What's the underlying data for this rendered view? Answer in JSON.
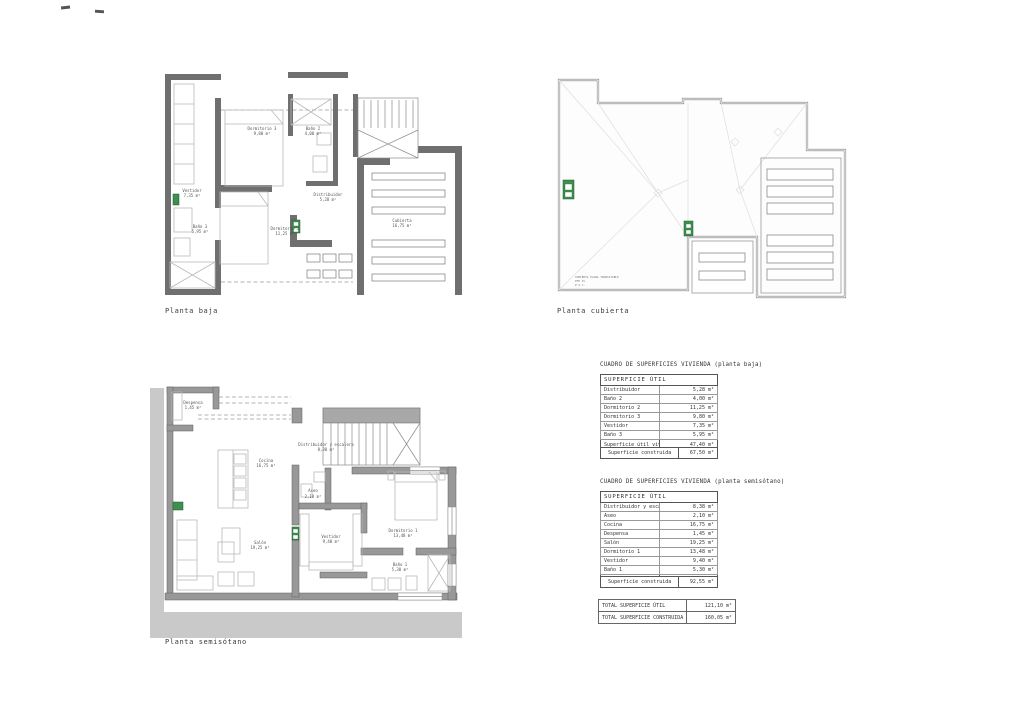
{
  "plans": {
    "baja": {
      "title": "Planta baja",
      "rooms": {
        "vestidor": {
          "name": "Vestidor",
          "area": "7,35 m²"
        },
        "bano3": {
          "name": "Baño 3",
          "area": "5,95 m²"
        },
        "dormitorio3": {
          "name": "Dormitorio 3",
          "area": "9,80 m²"
        },
        "bano2": {
          "name": "Baño 2",
          "area": "4,00 m²"
        },
        "distribuidor": {
          "name": "Distribuidor",
          "area": "5,28 m²"
        },
        "dormitorio2": {
          "name": "Dormitorio 2",
          "area": "11,25 m²"
        },
        "cubierta": {
          "name": "Cubierta",
          "area": "16,75 m²"
        }
      }
    },
    "cubierta": {
      "title": "Planta cubierta",
      "note1": "CUBIERTA PLANA TRANSITABLE",
      "note2": "PTE 4%",
      "note3": "P.V.C."
    },
    "semisotano": {
      "title": "Planta semisótano",
      "rooms": {
        "despensa": {
          "name": "Despensa",
          "area": "1,45 m²"
        },
        "cocina": {
          "name": "Cocina",
          "area": "16,75 m²"
        },
        "distribuidor": {
          "name": "Distribuidor y escalera",
          "area": "8,38 m²"
        },
        "aseo": {
          "name": "Aseo",
          "area": "2,10 m²"
        },
        "salon": {
          "name": "Salón",
          "area": "19,25 m²"
        },
        "vestidor": {
          "name": "Vestidor",
          "area": "9,40 m²"
        },
        "dormitorio1": {
          "name": "Dormitorio 1",
          "area": "13,48 m²"
        },
        "bano1": {
          "name": "Baño 1",
          "area": "5,30 m²"
        }
      }
    }
  },
  "tables": {
    "baja": {
      "title": "CUADRO DE SUPERFICIES VIVIENDA (planta baja)",
      "header": "SUPERFICIE ÚTIL",
      "rows": [
        [
          "Distribuidor",
          "5,28 m²"
        ],
        [
          "Baño 2",
          "4,00 m²"
        ],
        [
          "Dormitorio 2",
          "11,25 m²"
        ],
        [
          "Dormitorio 3",
          "9,80 m²"
        ],
        [
          "Vestidor",
          "7,35 m²"
        ],
        [
          "Baño 3",
          "5,95 m²"
        ]
      ],
      "subtotal_label": "Superficie útil vivienda",
      "subtotal_value": "47,40 m²",
      "construida_label": "Superficie construida",
      "construida_value": "67,50 m²"
    },
    "semisotano": {
      "title": "CUADRO DE SUPERFICIES VIVIENDA (planta semisótano)",
      "header": "SUPERFICIE ÚTIL",
      "rows": [
        [
          "Distribuidor y escalera",
          "8,38 m²"
        ],
        [
          "Aseo",
          "2,10 m²"
        ],
        [
          "Cocina",
          "16,75 m²"
        ],
        [
          "Despensa",
          "1,45 m²"
        ],
        [
          "Salón",
          "19,25 m²"
        ],
        [
          "Dormitorio 1",
          "13,48 m²"
        ],
        [
          "Vestidor",
          "9,40 m²"
        ],
        [
          "Baño 1",
          "5,30 m²"
        ]
      ],
      "subtotal_label": "Superficie útil",
      "subtotal_value": "73,70 m²",
      "construida_label": "Superficie construida",
      "construida_value": "92,55 m²"
    },
    "totals": {
      "rows": [
        [
          "TOTAL SUPERFICIE  ÚTIL",
          "121,10 m²"
        ],
        [
          "TOTAL SUPERFICIE  CONSTRUIDA",
          "160,05 m²"
        ]
      ]
    }
  }
}
